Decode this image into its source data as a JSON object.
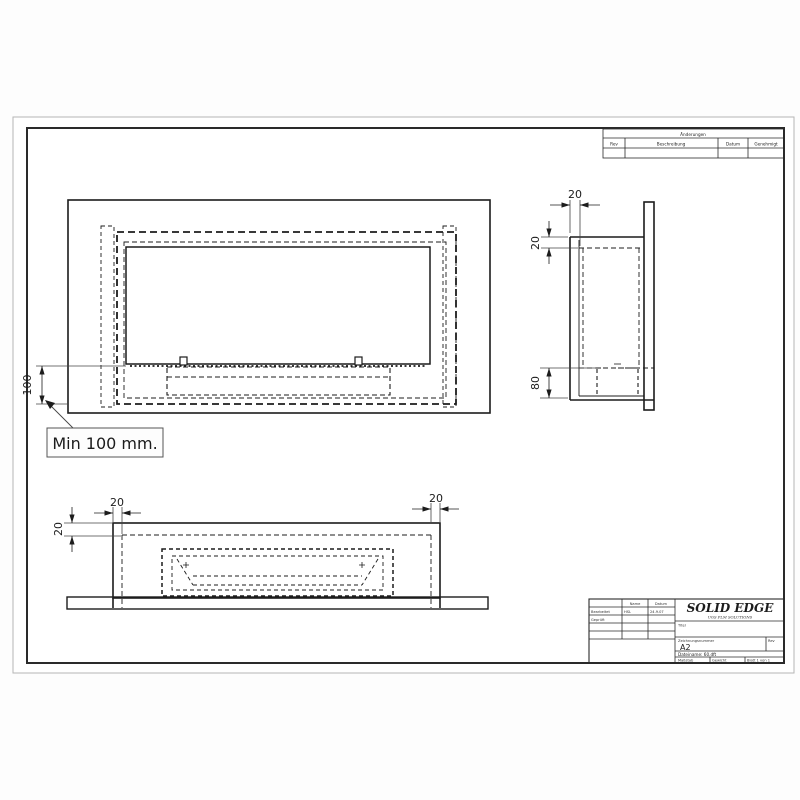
{
  "sheet": {
    "revision_table": {
      "title": "Änderungen",
      "col_rev": "Rev",
      "col_desc": "Beschreibung",
      "col_date": "Datum",
      "col_appr": "Genehmigt"
    },
    "dims": {
      "front_height": "100",
      "note": "Min 100 mm.",
      "side_wall": "20",
      "side_top_wall": "20",
      "side_burner_height": "80",
      "bottom_wall_left": "20",
      "bottom_wall_right": "20",
      "bottom_top_wall": "20"
    },
    "title_block": {
      "header_name": "Name",
      "header_date": "Datum",
      "row1_label": "Bearbeitet",
      "row1_name": "HSL",
      "row1_date": "24.9.07",
      "row2_label": "Geprüft",
      "brand": "SOLID EDGE",
      "brand_sub": "UGS PLM SOLUTIONS",
      "title_label": "Titel",
      "number_label": "Zeichnungsnummer",
      "size_value": "A2",
      "rev_label": "Rev",
      "file_line": "Dateiname: 60.dft",
      "scale_label": "Maßstab",
      "weight_label": "Gewicht",
      "sheet_value": "Blatt 1 von 1"
    }
  }
}
